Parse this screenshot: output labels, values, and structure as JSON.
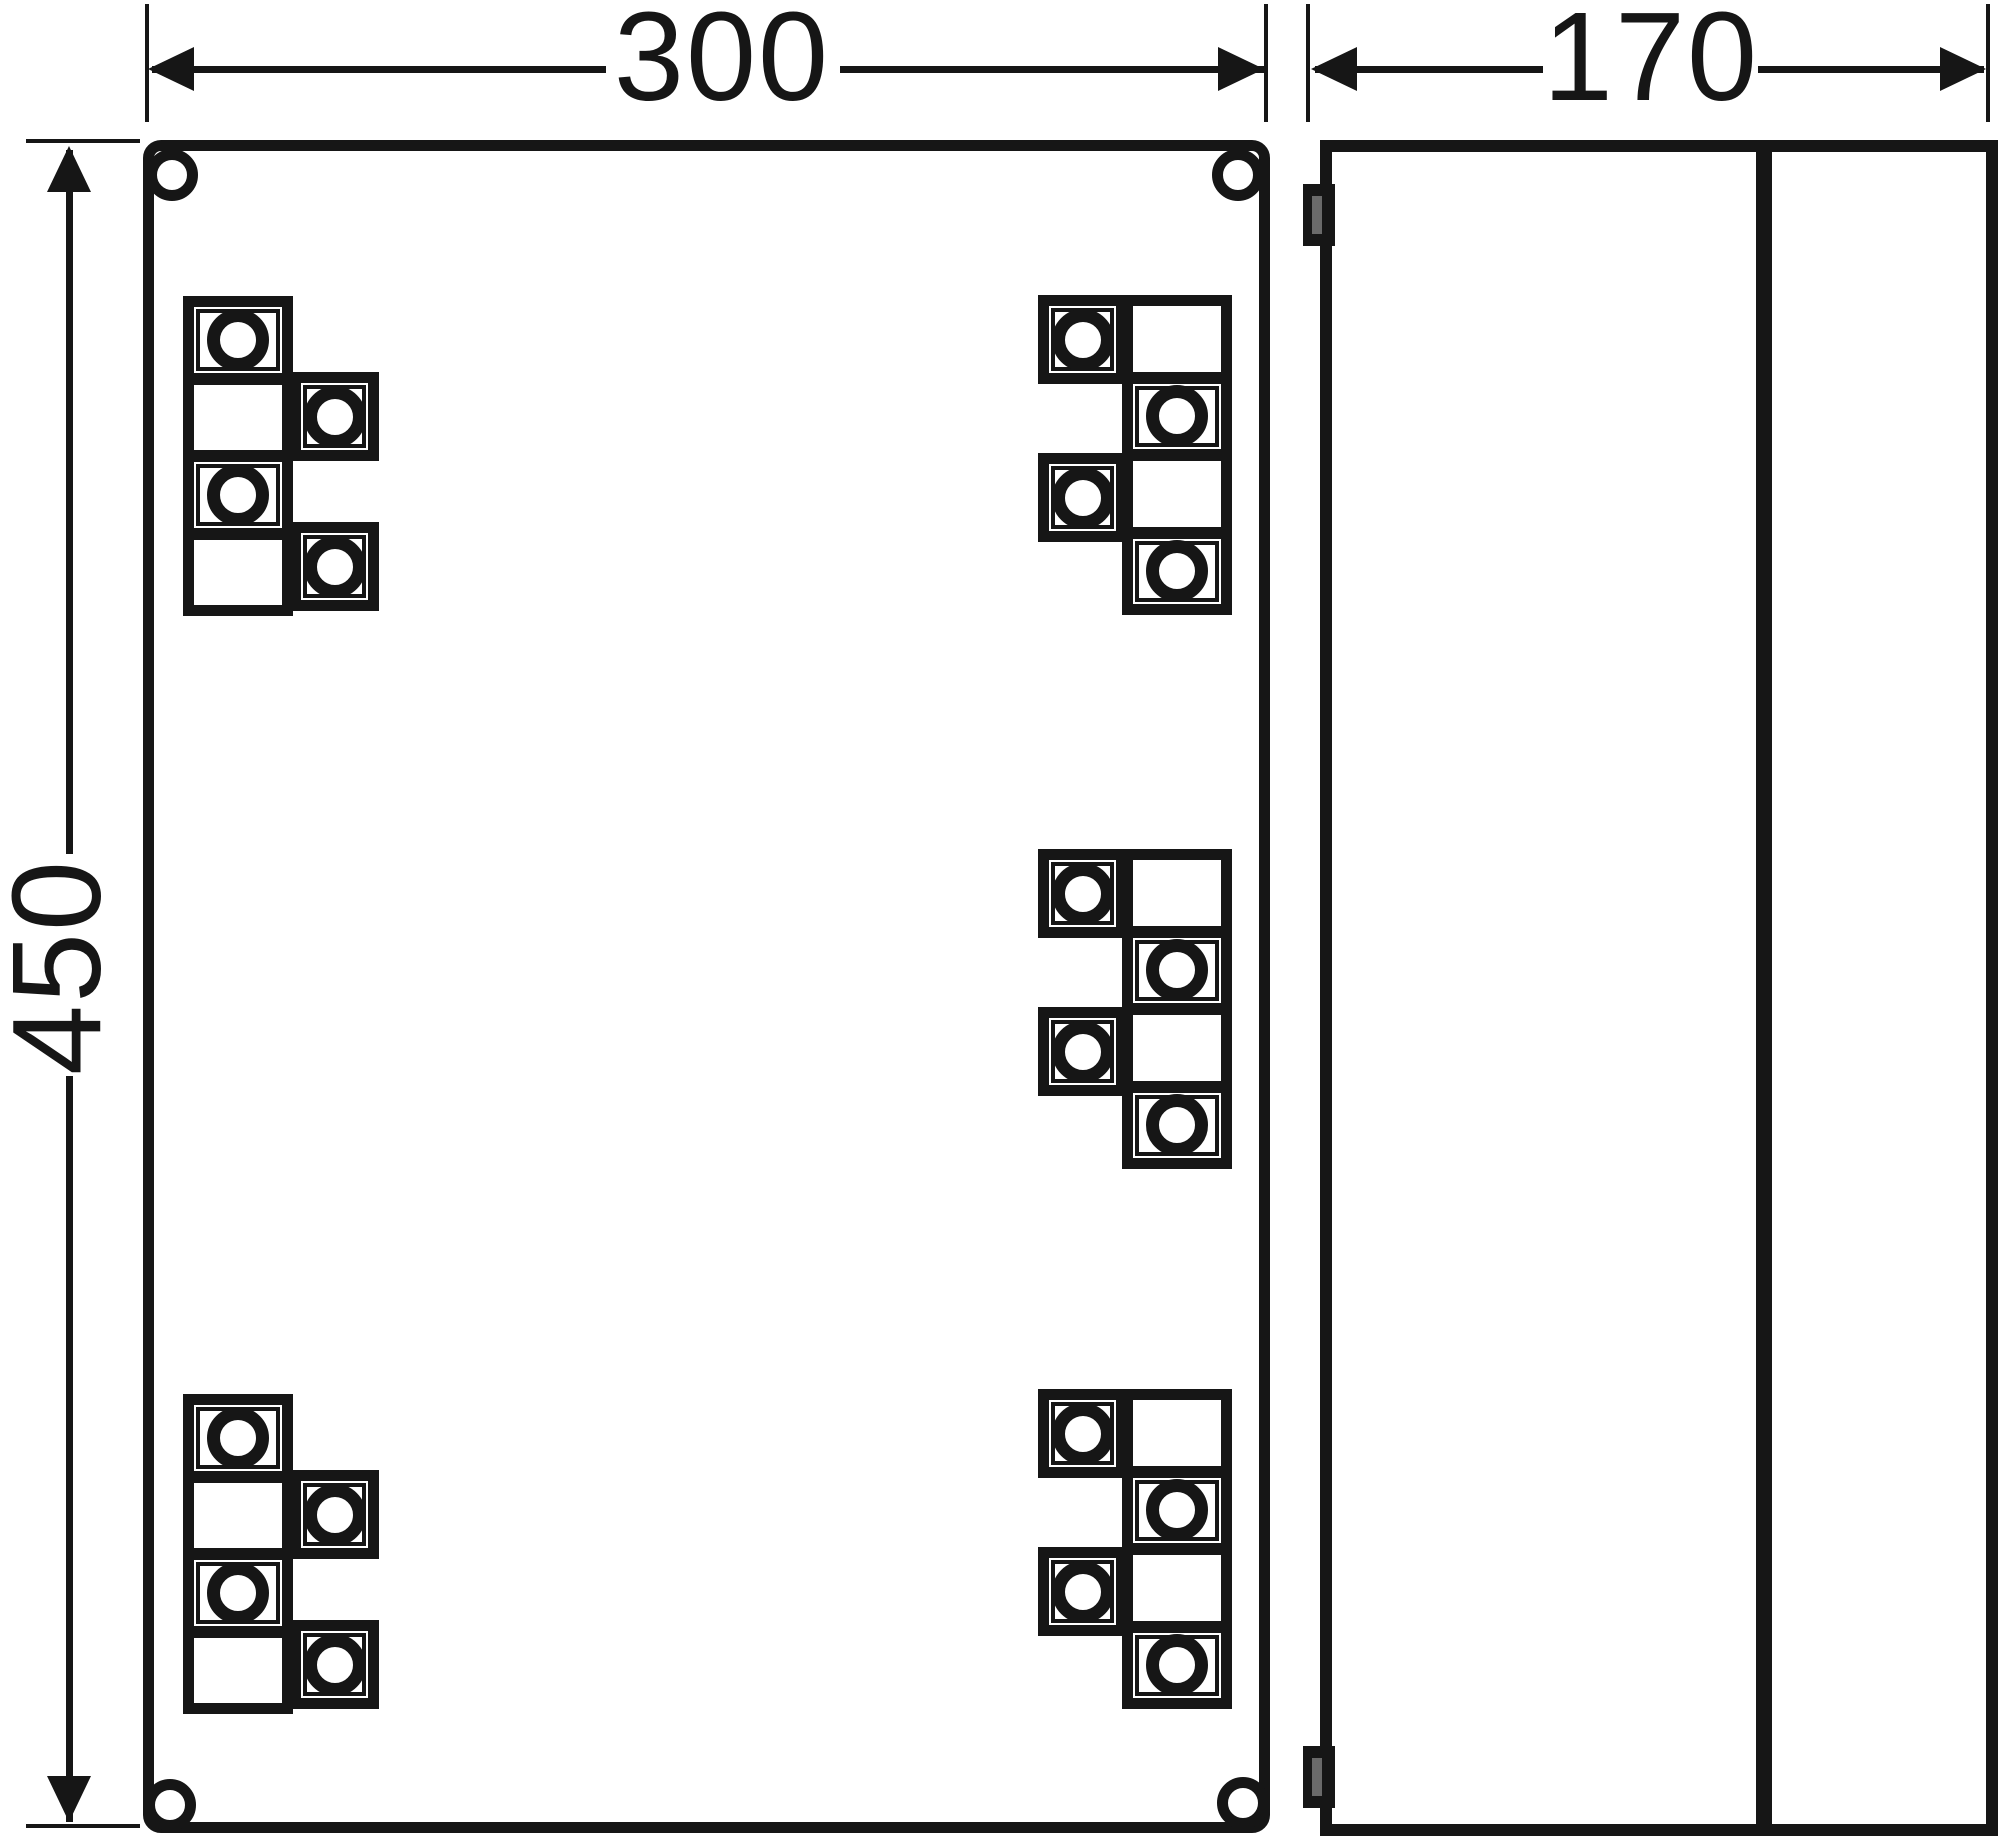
{
  "drawing": {
    "type": "enclosure dimensional drawing, front and side view",
    "line_color": "#161616",
    "background_color": "#ffffff",
    "slot_color": "#6a6a6a"
  },
  "dimensions": {
    "width": {
      "value": "300"
    },
    "depth": {
      "value": "170"
    },
    "height": {
      "value": "450"
    }
  },
  "front_view": {
    "corner_screws": [
      {
        "id": "top-left",
        "x": 146,
        "y": 149
      },
      {
        "id": "top-right",
        "x": 1212,
        "y": 149
      },
      {
        "id": "bottom-left",
        "x": 144,
        "y": 1779
      },
      {
        "id": "bottom-right",
        "x": 1217,
        "y": 1777
      }
    ],
    "terminal_groups": [
      {
        "id": "top-left",
        "variant": "left",
        "x": 183,
        "y": 296,
        "terminals": 4
      },
      {
        "id": "top-right",
        "variant": "right",
        "x": 1038,
        "y": 295,
        "terminals": 4
      },
      {
        "id": "middle-right",
        "variant": "right",
        "x": 1038,
        "y": 849,
        "terminals": 4
      },
      {
        "id": "bottom-left",
        "variant": "left",
        "x": 183,
        "y": 1394,
        "terminals": 4
      },
      {
        "id": "bottom-right",
        "variant": "right",
        "x": 1038,
        "y": 1389,
        "terminals": 4
      }
    ]
  },
  "side_view": {
    "hinge_tabs": [
      {
        "id": "top",
        "y": 32
      },
      {
        "id": "bottom",
        "y": 1594
      }
    ]
  }
}
